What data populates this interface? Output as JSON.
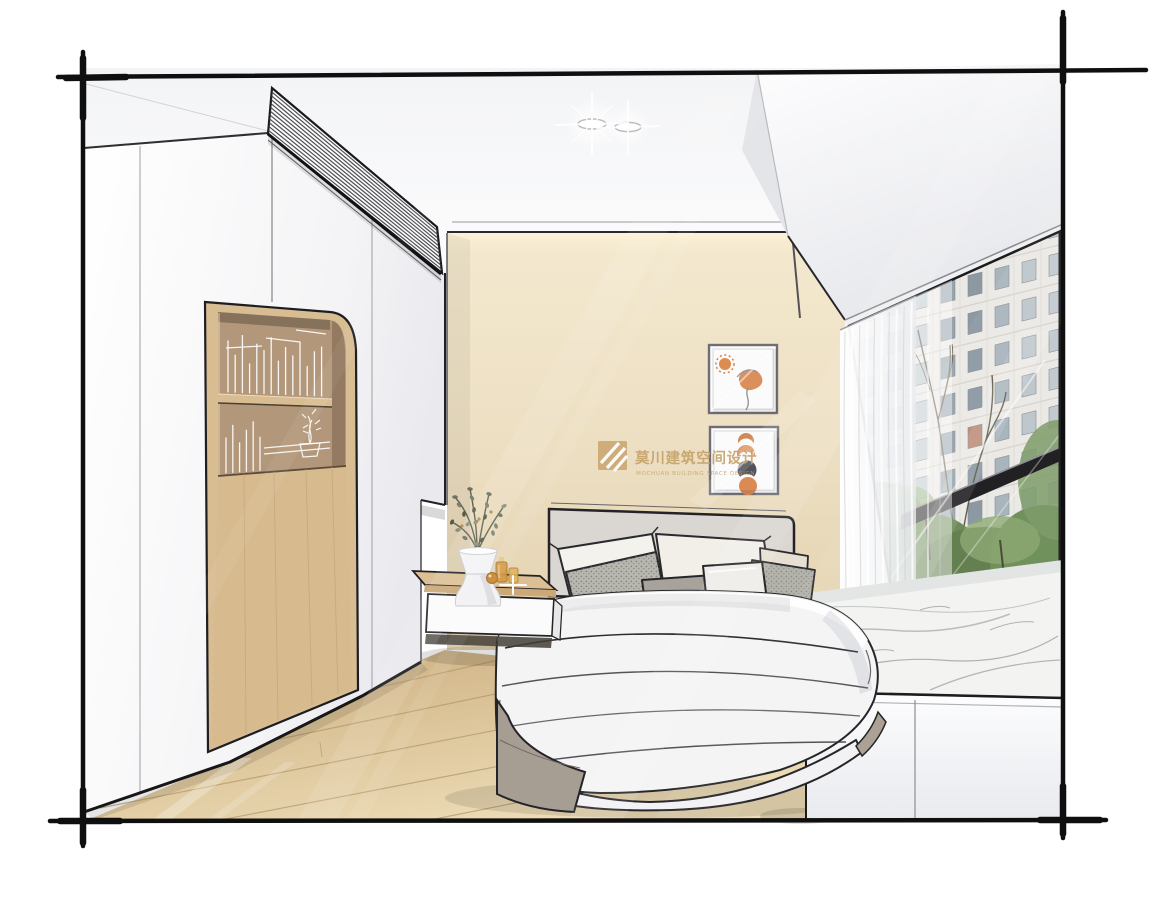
{
  "scene": {
    "kind": "hand-drawn interior design rendering",
    "room": "bedroom with wardrobe, bed and marble bay window"
  },
  "brand_watermark": {
    "icon": "mochuan-logo",
    "text_cn": "莫川建筑空间设计",
    "text_en": "MOCHUAN BUILDING SPACE DESIGN",
    "color": "#C5A066"
  },
  "glass_watermark": {
    "text": "知末"
  },
  "palette": {
    "sketch_line": "#1B1B1E",
    "wall_beige": "#EBDCC0",
    "cabinet_wood": "#D8BC92",
    "floor_wood": "#DECBA0",
    "marble": "#F3F4F2",
    "art_orange": "#D98A55",
    "art_dark": "#52525A",
    "foliage_green": "#6C7160",
    "accent_gold": "#C5A066"
  }
}
